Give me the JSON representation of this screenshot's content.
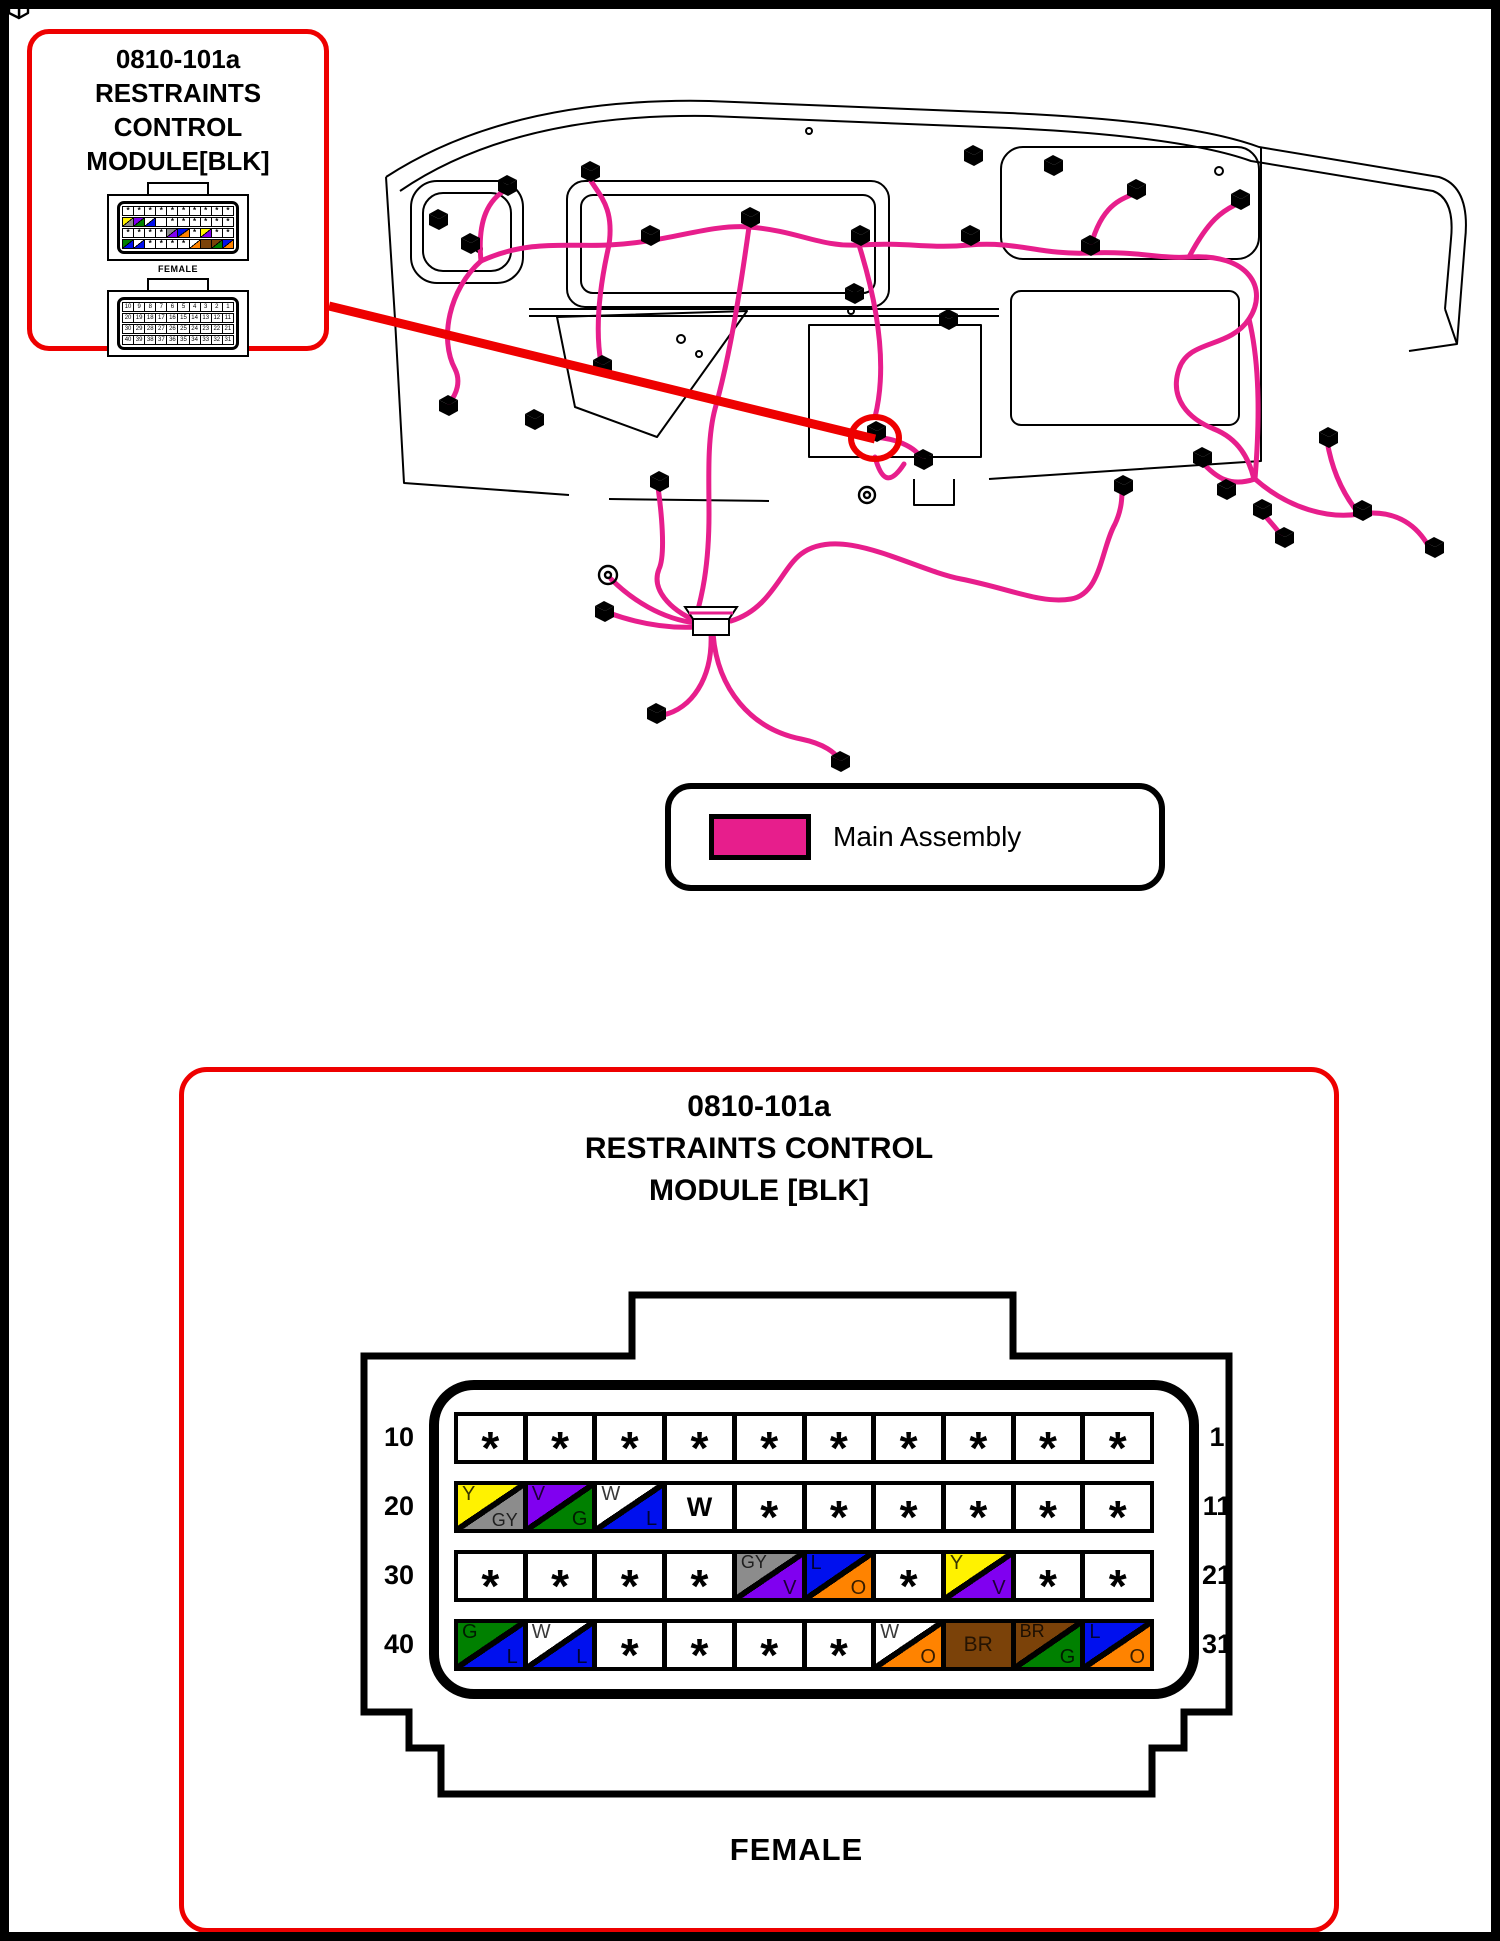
{
  "page": {
    "background": "#FFFFFF",
    "border_color": "#000000"
  },
  "colors": {
    "harness_pink": "#E71E8C",
    "highlight_red": "#EE0000",
    "line_black": "#000000"
  },
  "wire_colors": {
    "Y": "#FFF200",
    "GY": "#8C8C8C",
    "V": "#8000F0",
    "G": "#008000",
    "W": "#FFFFFF",
    "L": "#0010EE",
    "O": "#FF8300",
    "BR": "#7B4209"
  },
  "callout": {
    "title_lines": [
      "0810-101a",
      "RESTRAINTS",
      "CONTROL",
      "MODULE[BLK]"
    ],
    "connector_caption": "FEMALE"
  },
  "legend": {
    "swatch_color": "#E71E8C",
    "label": "Main Assembly"
  },
  "module": {
    "title_lines": [
      "0810-101a",
      "RESTRAINTS CONTROL",
      "MODULE [BLK]"
    ],
    "connector_gender_label": "FEMALE",
    "star_symbol": "*",
    "rows": [
      {
        "left": "10",
        "right": "1",
        "pins": [
          {
            "t": "*"
          },
          {
            "t": "*"
          },
          {
            "t": "*"
          },
          {
            "t": "*"
          },
          {
            "t": "*"
          },
          {
            "t": "*"
          },
          {
            "t": "*"
          },
          {
            "t": "*"
          },
          {
            "t": "*"
          },
          {
            "t": "*"
          }
        ]
      },
      {
        "left": "20",
        "right": "11",
        "pins": [
          {
            "t": "s",
            "a": "Y",
            "b": "GY"
          },
          {
            "t": "s",
            "a": "V",
            "b": "G"
          },
          {
            "t": "s",
            "a": "W",
            "b": "L"
          },
          {
            "t": "f",
            "c": "W"
          },
          {
            "t": "*"
          },
          {
            "t": "*"
          },
          {
            "t": "*"
          },
          {
            "t": "*"
          },
          {
            "t": "*"
          },
          {
            "t": "*"
          }
        ]
      },
      {
        "left": "30",
        "right": "21",
        "pins": [
          {
            "t": "*"
          },
          {
            "t": "*"
          },
          {
            "t": "*"
          },
          {
            "t": "*"
          },
          {
            "t": "s",
            "a": "GY",
            "b": "V"
          },
          {
            "t": "s",
            "a": "L",
            "b": "O"
          },
          {
            "t": "*"
          },
          {
            "t": "s",
            "a": "Y",
            "b": "V"
          },
          {
            "t": "*"
          },
          {
            "t": "*"
          }
        ]
      },
      {
        "left": "40",
        "right": "31",
        "pins": [
          {
            "t": "s",
            "a": "G",
            "b": "L"
          },
          {
            "t": "s",
            "a": "W",
            "b": "L"
          },
          {
            "t": "*"
          },
          {
            "t": "*"
          },
          {
            "t": "*"
          },
          {
            "t": "*"
          },
          {
            "t": "s",
            "a": "W",
            "b": "O"
          },
          {
            "t": "f",
            "c": "BR"
          },
          {
            "t": "s",
            "a": "BR",
            "b": "G"
          },
          {
            "t": "s",
            "a": "L",
            "b": "O"
          }
        ]
      }
    ]
  }
}
